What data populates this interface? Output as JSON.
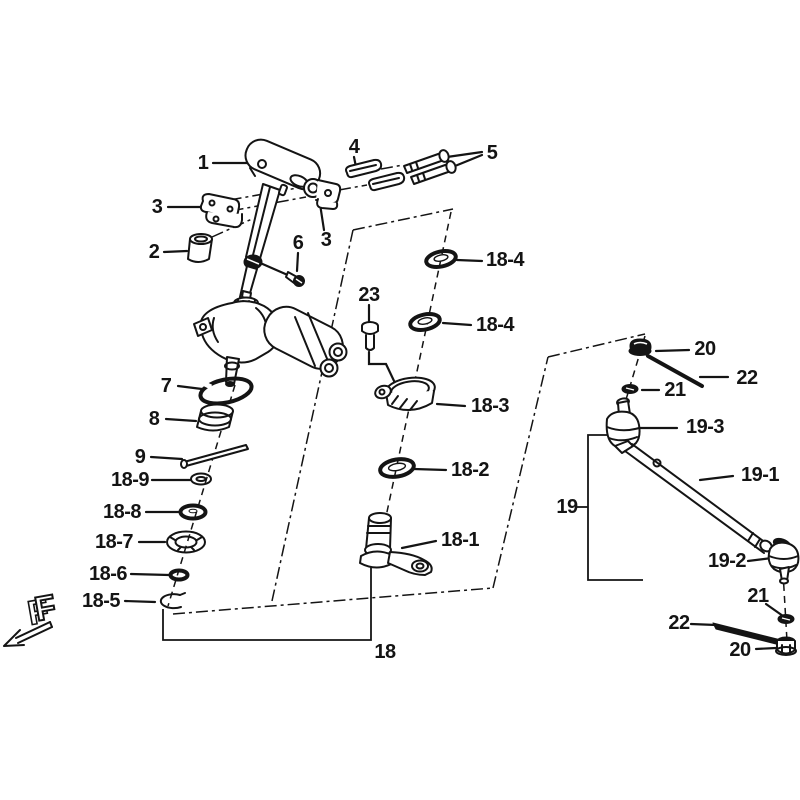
{
  "diagram": {
    "type": "exploded-parts-diagram",
    "colors": {
      "line": "#141414",
      "background": "#ffffff"
    },
    "front_indicator": "F",
    "labels": {
      "n1": "1",
      "n2": "2",
      "n3a": "3",
      "n3b": "3",
      "n4": "4",
      "n5": "5",
      "n6": "6",
      "n7": "7",
      "n8": "8",
      "n9": "9",
      "n23": "23",
      "n18": "18",
      "n18_1": "18-1",
      "n18_2": "18-2",
      "n18_3": "18-3",
      "n18_4a": "18-4",
      "n18_4b": "18-4",
      "n18_5": "18-5",
      "n18_6": "18-6",
      "n18_7": "18-7",
      "n18_8": "18-8",
      "n18_9": "18-9",
      "n19": "19",
      "n19_1": "19-1",
      "n19_2": "19-2",
      "n19_3": "19-3",
      "n20a": "20",
      "n20b": "20",
      "n21a": "21",
      "n21b": "21",
      "n22a": "22",
      "n22b": "22"
    }
  }
}
